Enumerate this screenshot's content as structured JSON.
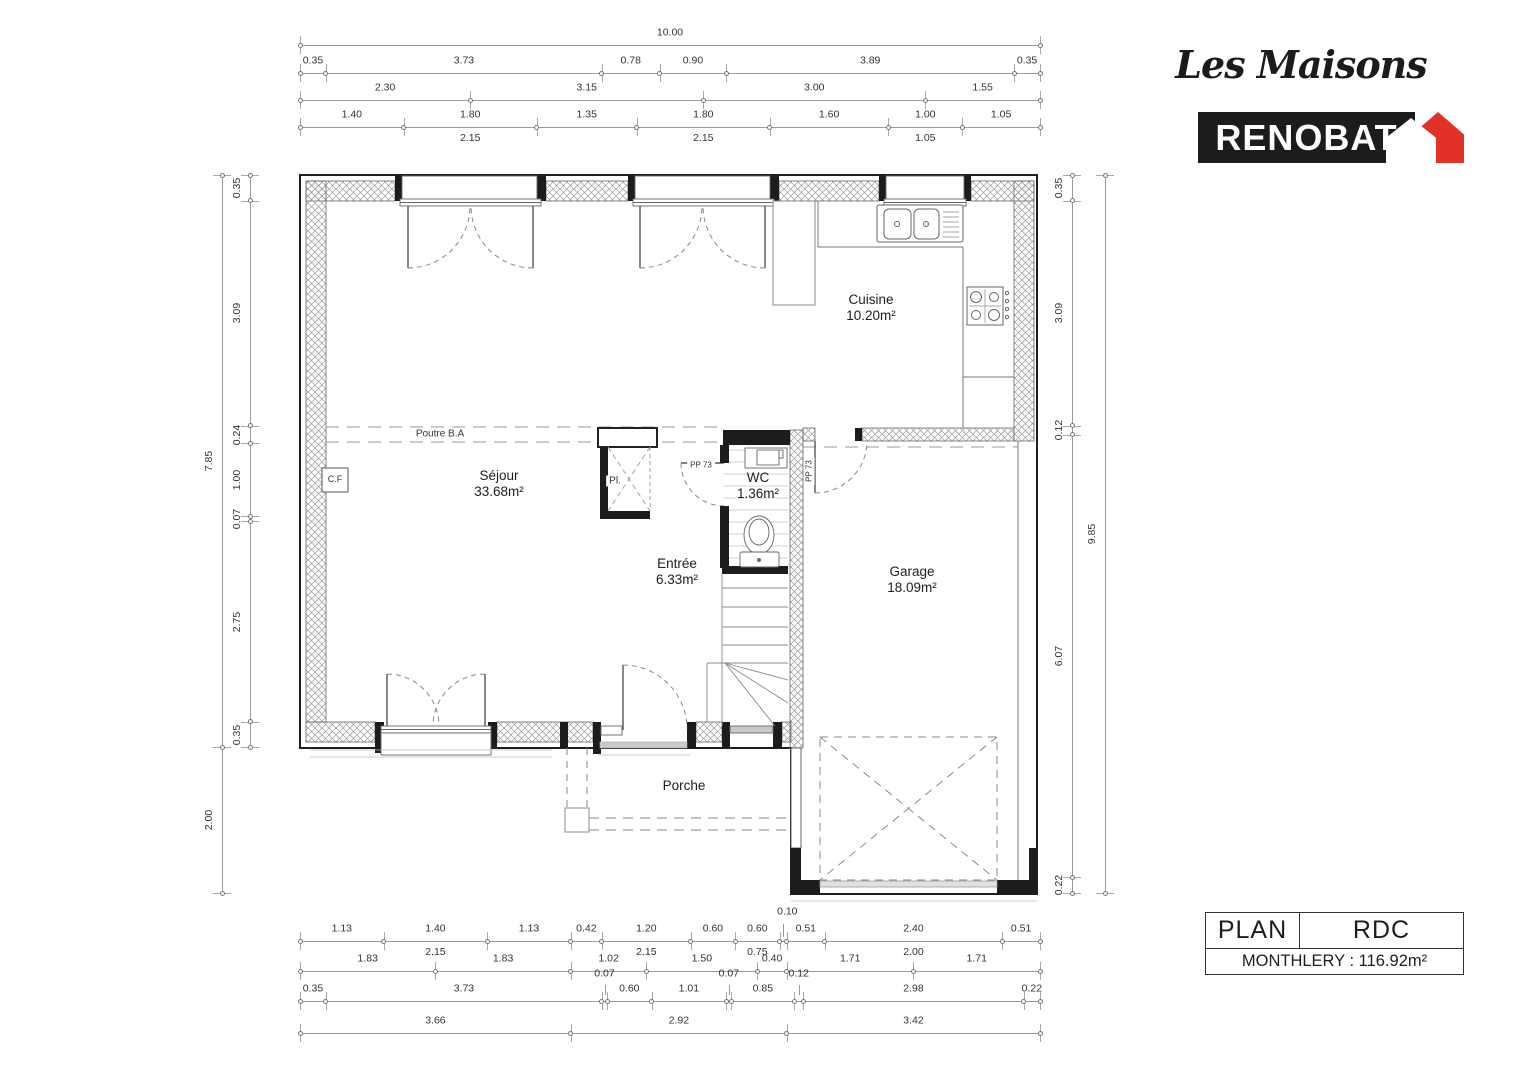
{
  "colors": {
    "brand_red": "#e23128",
    "ink": "#1c1c1c",
    "hatch_gray": "#9a9a9a"
  },
  "logo": {
    "script_text": "Les Maisons",
    "brand_text": "RENOBAT"
  },
  "title_block": {
    "doc_type": "PLAN",
    "level": "RDC",
    "project": "MONTHLERY : 116.92m²"
  },
  "rooms": [
    {
      "id": "cuisine",
      "name": "Cuisine",
      "area": "10.20m²",
      "x": 871,
      "y": 292
    },
    {
      "id": "sejour",
      "name": "Séjour",
      "area": "33.68m²",
      "x": 499,
      "y": 468
    },
    {
      "id": "wc",
      "name": "WC",
      "area": "1.36m²",
      "x": 758,
      "y": 470
    },
    {
      "id": "entree",
      "name": "Entrée",
      "area": "6.33m²",
      "x": 677,
      "y": 556
    },
    {
      "id": "garage",
      "name": "Garage",
      "area": "18.09m²",
      "x": 912,
      "y": 564
    },
    {
      "id": "porche",
      "name": "Porche",
      "area": "",
      "x": 684,
      "y": 778
    }
  ],
  "annotations": [
    {
      "id": "poutre",
      "text": "Poutre B.A",
      "x": 440,
      "y": 434,
      "size": 10,
      "rot": 0
    },
    {
      "id": "cf",
      "text": "C.F",
      "x": 335,
      "y": 480,
      "size": 9,
      "rot": 0
    },
    {
      "id": "placard",
      "text": "Pl.",
      "x": 615,
      "y": 481,
      "size": 10,
      "rot": 0
    },
    {
      "id": "pp73-wc",
      "text": "PP 73",
      "x": 701,
      "y": 466,
      "size": 8,
      "rot": 0
    },
    {
      "id": "pp73-garage",
      "text": "PP 73",
      "x": 810,
      "y": 471,
      "size": 8,
      "rot": -90
    }
  ],
  "dimensions": {
    "px_per_m_h": 74,
    "px_per_m_v": 72.9,
    "chains": [
      {
        "id": "top-total",
        "dir": "h",
        "x": 300,
        "y": 45,
        "segs": [
          {
            "m": 10.0,
            "l": "10.00"
          }
        ]
      },
      {
        "id": "top-openings",
        "dir": "h",
        "x": 300,
        "y": 73,
        "segs": [
          {
            "m": 0.35,
            "l": "0.35"
          },
          {
            "m": 3.73,
            "l": "3.73"
          },
          {
            "m": 0.78,
            "l": "0.78"
          },
          {
            "m": 0.9,
            "l": "0.90"
          },
          {
            "m": 3.89,
            "l": "3.89"
          },
          {
            "m": 0.35,
            "l": "0.35"
          }
        ]
      },
      {
        "id": "top-axes",
        "dir": "h",
        "x": 300,
        "y": 100,
        "segs": [
          {
            "m": 2.3,
            "l": "2.30"
          },
          {
            "m": 3.15,
            "l": "3.15"
          },
          {
            "m": 3.0,
            "l": "3.00"
          },
          {
            "m": 1.55,
            "l": "1.55"
          }
        ]
      },
      {
        "id": "top-frames",
        "dir": "h",
        "x": 300,
        "y": 127,
        "segs": [
          {
            "m": 1.4,
            "l": "1.40"
          },
          {
            "m": 1.8,
            "l": "1.80",
            "s": "2.15"
          },
          {
            "m": 1.35,
            "l": "1.35"
          },
          {
            "m": 1.8,
            "l": "1.80",
            "s": "2.15"
          },
          {
            "m": 1.6,
            "l": "1.60"
          },
          {
            "m": 1.0,
            "l": "1.00",
            "s": "1.05"
          },
          {
            "m": 1.05,
            "l": "1.05"
          }
        ]
      },
      {
        "id": "left-outer",
        "dir": "v",
        "x": 222,
        "y": 175,
        "segs": [
          {
            "m": 7.85,
            "l": "7.85"
          },
          {
            "m": 2.0,
            "l": "2.00"
          }
        ]
      },
      {
        "id": "left-wall",
        "dir": "v",
        "x": 250,
        "y": 175,
        "segs": [
          {
            "m": 0.35,
            "l": "0.35"
          },
          {
            "m": 3.09,
            "l": "3.09"
          },
          {
            "m": 0.24,
            "l": "0.24"
          },
          {
            "m": 1.0,
            "l": "1.00"
          },
          {
            "m": 0.07,
            "l": "0.07"
          },
          {
            "m": 2.75,
            "l": "2.75"
          },
          {
            "m": 0.35,
            "l": "0.35"
          }
        ]
      },
      {
        "id": "right-wall",
        "dir": "v",
        "x": 1072,
        "y": 175,
        "segs": [
          {
            "m": 0.35,
            "l": "0.35"
          },
          {
            "m": 3.09,
            "l": "3.09"
          },
          {
            "m": 0.12,
            "l": "0.12"
          },
          {
            "m": 6.07,
            "l": "6.07"
          },
          {
            "m": 0.22,
            "l": "0.22"
          }
        ]
      },
      {
        "id": "right-outer",
        "dir": "v",
        "x": 1105,
        "y": 175,
        "segs": [
          {
            "m": 9.85,
            "l": "9.85"
          }
        ]
      },
      {
        "id": "bottom-frames",
        "dir": "h",
        "x": 300,
        "y": 941,
        "segs": [
          {
            "m": 1.13,
            "l": "1.13"
          },
          {
            "m": 1.4,
            "l": "1.40",
            "s": "2.15"
          },
          {
            "m": 1.13,
            "l": "1.13"
          },
          {
            "m": 0.42,
            "l": "0.42"
          },
          {
            "m": 1.2,
            "l": "1.20",
            "s": "2.15"
          },
          {
            "m": 0.6,
            "l": "0.60"
          },
          {
            "m": 0.6,
            "l": "0.60",
            "s": "0.75"
          },
          {
            "m": 0.1,
            "l": "0.10",
            "c": true
          },
          {
            "m": 0.51,
            "l": "0.51"
          },
          {
            "m": 2.4,
            "l": "2.40",
            "s": "2.00"
          },
          {
            "m": 0.51,
            "l": "0.51"
          }
        ]
      },
      {
        "id": "bottom-axes",
        "dir": "h",
        "x": 300,
        "y": 971,
        "segs": [
          {
            "m": 1.83,
            "l": "1.83"
          },
          {
            "m": 1.83,
            "l": "1.83"
          },
          {
            "m": 1.02,
            "l": "1.02"
          },
          {
            "m": 1.5,
            "l": "1.50"
          },
          {
            "m": 0.4,
            "l": "0.40"
          },
          {
            "m": 1.71,
            "l": "1.71"
          },
          {
            "m": 1.71,
            "l": "1.71"
          }
        ]
      },
      {
        "id": "bottom-walls",
        "dir": "h",
        "x": 300,
        "y": 1001,
        "segs": [
          {
            "m": 0.35,
            "l": "0.35"
          },
          {
            "m": 3.73,
            "l": "3.73"
          },
          {
            "m": 0.07,
            "l": "0.07",
            "r": true
          },
          {
            "m": 0.6,
            "l": "0.60"
          },
          {
            "m": 1.01,
            "l": "1.01"
          },
          {
            "m": 0.07,
            "l": "0.07",
            "r": true
          },
          {
            "m": 0.85,
            "l": "0.85"
          },
          {
            "m": 0.12,
            "l": "0.12",
            "r": true
          },
          {
            "m": 2.98,
            "l": "2.98"
          },
          {
            "m": 0.22,
            "l": "0.22"
          }
        ]
      },
      {
        "id": "bottom-total",
        "dir": "h",
        "x": 300,
        "y": 1033,
        "segs": [
          {
            "m": 3.66,
            "l": "3.66"
          },
          {
            "m": 2.92,
            "l": "2.92"
          },
          {
            "m": 3.42,
            "l": "3.42"
          }
        ]
      }
    ]
  }
}
